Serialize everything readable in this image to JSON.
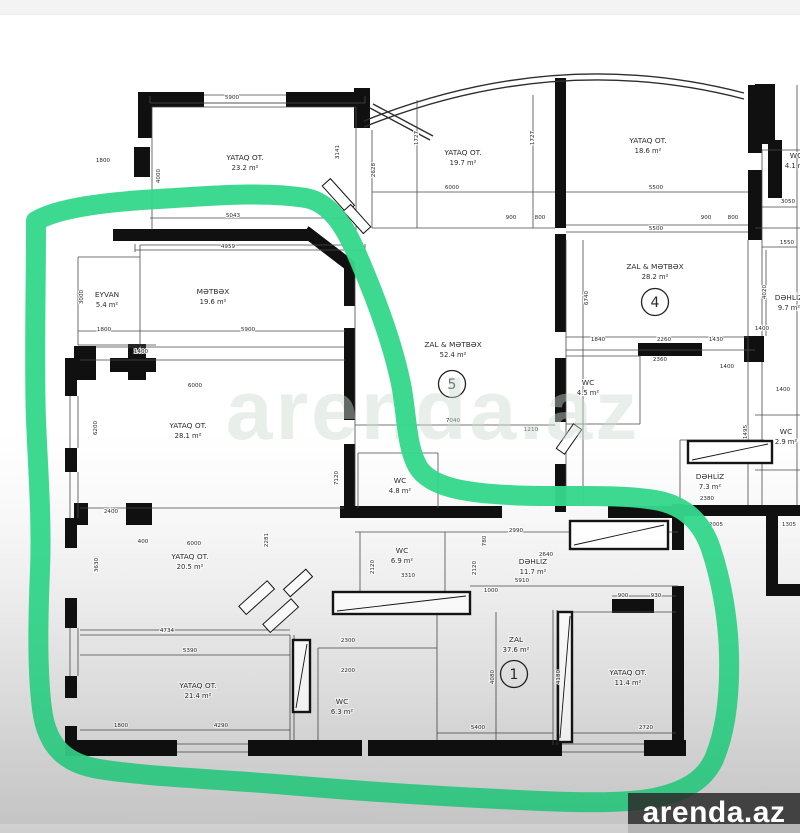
{
  "page": {
    "type": "real-estate floor plan photo",
    "top_strip_color": "#f3f3f3",
    "paper_color": "#ffffff"
  },
  "watermark": {
    "label": "arenda.az",
    "bg": "#2a2a2a",
    "color": "#ffffff"
  },
  "ghost_watermark": {
    "label": "arenda.az"
  },
  "annotation": {
    "type": "freehand-highlight-loop",
    "color": "#35d78c"
  },
  "plan": {
    "unit": "m²",
    "rooms": [
      {
        "name": "YATAQ OT.",
        "area": "23.2 m²",
        "x": 245,
        "y": 160
      },
      {
        "name": "YATAQ OT.",
        "area": "19.7 m²",
        "x": 463,
        "y": 155
      },
      {
        "name": "YATAQ OT.",
        "area": "18.6 m²",
        "x": 648,
        "y": 143
      },
      {
        "name": "EYVAN",
        "area": "5.4 m²",
        "x": 107,
        "y": 297
      },
      {
        "name": "MƏTBƏX",
        "area": "19.6 m²",
        "x": 213,
        "y": 294
      },
      {
        "name": "ZAL & MƏTBƏX",
        "area": "52.4 m²",
        "x": 453,
        "y": 347,
        "num": "5",
        "nx": 452,
        "ny": 384
      },
      {
        "name": "ZAL & MƏTBƏX",
        "area": "28.2 m²",
        "x": 655,
        "y": 269,
        "num": "4",
        "nx": 655,
        "ny": 302
      },
      {
        "name": "DƏHLİZ",
        "area": "9.7 m²",
        "x": 789,
        "y": 300
      },
      {
        "name": "WC",
        "area": "4.5 m²",
        "x": 588,
        "y": 385
      },
      {
        "name": "WC",
        "area": "4.8 m²",
        "x": 400,
        "y": 483
      },
      {
        "name": "DƏHLİZ",
        "area": "7.3 m²",
        "x": 710,
        "y": 479
      },
      {
        "name": "WC",
        "area": "2.9 m²",
        "x": 786,
        "y": 434
      },
      {
        "name": "WC",
        "area": "4.1 m²",
        "x": 796,
        "y": 158
      },
      {
        "name": "YATAQ OT.",
        "area": "28.1 m²",
        "x": 188,
        "y": 428
      },
      {
        "name": "YATAQ OT.",
        "area": "20.5 m²",
        "x": 190,
        "y": 559
      },
      {
        "name": "WC",
        "area": "6.9 m²",
        "x": 402,
        "y": 553
      },
      {
        "name": "DƏHLİZ",
        "area": "11.7 m²",
        "x": 533,
        "y": 564
      },
      {
        "name": "ZAL",
        "area": "37.6 m²",
        "x": 516,
        "y": 642,
        "num": "1",
        "nx": 514,
        "ny": 674
      },
      {
        "name": "YATAQ OT.",
        "area": "11.4 m²",
        "x": 628,
        "y": 675
      },
      {
        "name": "YATAQ OT.",
        "area": "21.4 m²",
        "x": 198,
        "y": 688
      },
      {
        "name": "WC",
        "area": "6.3 m²",
        "x": 342,
        "y": 704
      }
    ],
    "dimensions": [
      {
        "v": "5900",
        "x": 232,
        "y": 99
      },
      {
        "v": "1800",
        "x": 103,
        "y": 162
      },
      {
        "v": "4000",
        "x": 160,
        "y": 176,
        "r": 1
      },
      {
        "v": "5043",
        "x": 233,
        "y": 217
      },
      {
        "v": "4959",
        "x": 228,
        "y": 248
      },
      {
        "v": "3141",
        "x": 339,
        "y": 152,
        "r": 1
      },
      {
        "v": "2628",
        "x": 375,
        "y": 170,
        "r": 1
      },
      {
        "v": "3000",
        "x": 83,
        "y": 297,
        "r": 1
      },
      {
        "v": "1800",
        "x": 104,
        "y": 331
      },
      {
        "v": "1400",
        "x": 141,
        "y": 353
      },
      {
        "v": "5900",
        "x": 248,
        "y": 331
      },
      {
        "v": "6000",
        "x": 195,
        "y": 387
      },
      {
        "v": "1727",
        "x": 418,
        "y": 138,
        "r": 1
      },
      {
        "v": "1727",
        "x": 534,
        "y": 138,
        "r": 1
      },
      {
        "v": "6000",
        "x": 452,
        "y": 189
      },
      {
        "v": "900",
        "x": 511,
        "y": 219
      },
      {
        "v": "800",
        "x": 540,
        "y": 219
      },
      {
        "v": "5500",
        "x": 656,
        "y": 189
      },
      {
        "v": "900",
        "x": 706,
        "y": 219
      },
      {
        "v": "800",
        "x": 733,
        "y": 219
      },
      {
        "v": "5500",
        "x": 656,
        "y": 230
      },
      {
        "v": "6740",
        "x": 588,
        "y": 298,
        "r": 1
      },
      {
        "v": "1840",
        "x": 598,
        "y": 341
      },
      {
        "v": "2260",
        "x": 664,
        "y": 341
      },
      {
        "v": "1430",
        "x": 716,
        "y": 341
      },
      {
        "v": "2360",
        "x": 660,
        "y": 361
      },
      {
        "v": "3050",
        "x": 788,
        "y": 203
      },
      {
        "v": "1550",
        "x": 787,
        "y": 244
      },
      {
        "v": "4020",
        "x": 766,
        "y": 292,
        "r": 1
      },
      {
        "v": "1400",
        "x": 727,
        "y": 368
      },
      {
        "v": "1400",
        "x": 783,
        "y": 391
      },
      {
        "v": "2380",
        "x": 707,
        "y": 500
      },
      {
        "v": "7120",
        "x": 338,
        "y": 478,
        "r": 1
      },
      {
        "v": "1210",
        "x": 531,
        "y": 431
      },
      {
        "v": "7040",
        "x": 453,
        "y": 422
      },
      {
        "v": "2400",
        "x": 111,
        "y": 513
      },
      {
        "v": "400",
        "x": 143,
        "y": 543
      },
      {
        "v": "6000",
        "x": 194,
        "y": 545
      },
      {
        "v": "3630",
        "x": 98,
        "y": 565,
        "r": 1
      },
      {
        "v": "2281",
        "x": 268,
        "y": 540,
        "r": 1
      },
      {
        "v": "4734",
        "x": 167,
        "y": 632
      },
      {
        "v": "5390",
        "x": 190,
        "y": 652
      },
      {
        "v": "1800",
        "x": 121,
        "y": 727
      },
      {
        "v": "4290",
        "x": 221,
        "y": 727
      },
      {
        "v": "2300",
        "x": 348,
        "y": 642
      },
      {
        "v": "2200",
        "x": 348,
        "y": 672
      },
      {
        "v": "2120",
        "x": 374,
        "y": 567,
        "r": 1
      },
      {
        "v": "2120",
        "x": 476,
        "y": 568,
        "r": 1
      },
      {
        "v": "3310",
        "x": 408,
        "y": 577
      },
      {
        "v": "1000",
        "x": 491,
        "y": 592
      },
      {
        "v": "2990",
        "x": 516,
        "y": 532
      },
      {
        "v": "780",
        "x": 486,
        "y": 541,
        "r": 1
      },
      {
        "v": "2640",
        "x": 546,
        "y": 556
      },
      {
        "v": "5910",
        "x": 522,
        "y": 582
      },
      {
        "v": "5400",
        "x": 478,
        "y": 729
      },
      {
        "v": "2720",
        "x": 646,
        "y": 729
      },
      {
        "v": "900",
        "x": 623,
        "y": 597
      },
      {
        "v": "930",
        "x": 656,
        "y": 597
      },
      {
        "v": "4080",
        "x": 494,
        "y": 677,
        "r": 1
      },
      {
        "v": "4180",
        "x": 560,
        "y": 677,
        "r": 1
      },
      {
        "v": "6200",
        "x": 97,
        "y": 428,
        "r": 1
      },
      {
        "v": "1495",
        "x": 747,
        "y": 432,
        "r": 1
      },
      {
        "v": "1400",
        "x": 762,
        "y": 330
      },
      {
        "v": "2005",
        "x": 716,
        "y": 526
      },
      {
        "v": "1305",
        "x": 789,
        "y": 526
      }
    ]
  }
}
